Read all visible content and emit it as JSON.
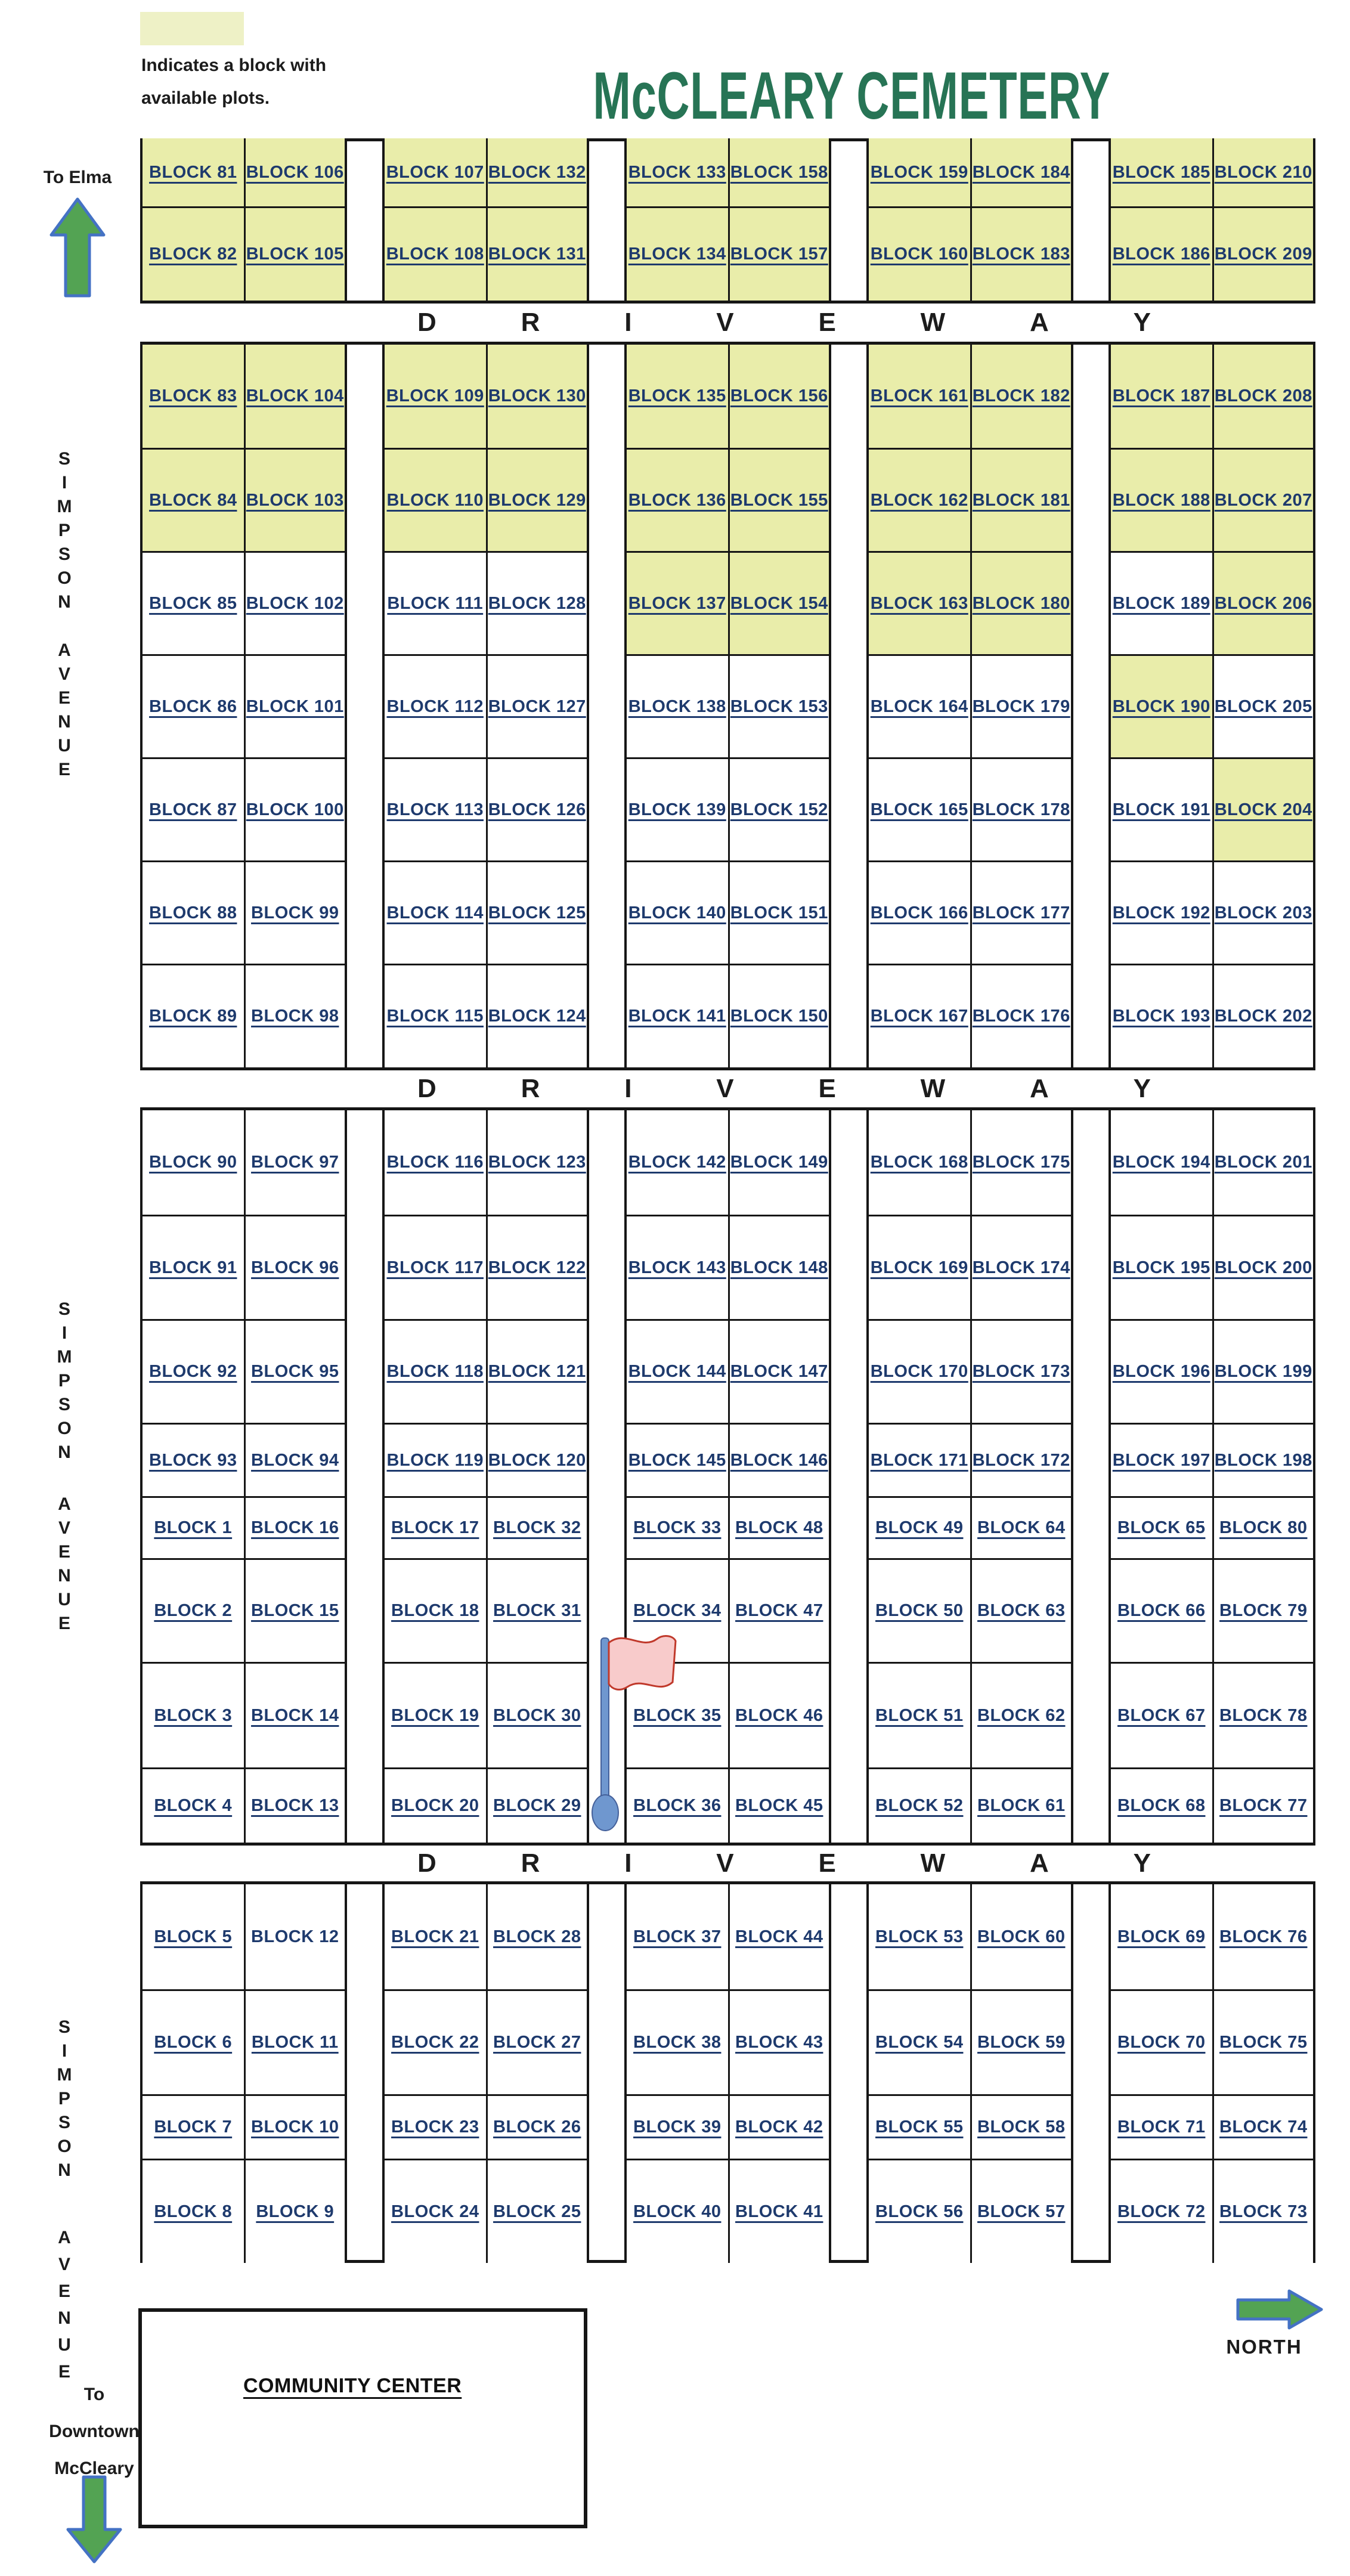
{
  "title": "McCLEARY CEMETERY",
  "legend": {
    "line1": "Indicates a block with",
    "line2": "available plots."
  },
  "driveway_letters": [
    "D",
    "R",
    "I",
    "V",
    "E",
    "W",
    "A",
    "Y"
  ],
  "streets": {
    "simpson": "SIMPSON",
    "avenue": "AVENUE"
  },
  "directions": {
    "to_elma": "To Elma",
    "to_downtown": [
      "To",
      "Downtown",
      "McCleary"
    ],
    "north": "NORTH"
  },
  "community_center": "COMMUNITY CENTER",
  "colors": {
    "available_fill": "#e9edaa",
    "legend_fill": "#eef1c6",
    "label_navy": "#1e3a6d",
    "title_green": "#277455",
    "arrow_green": "#53a353",
    "arrow_blue": "#4472c4",
    "flag_pink": "#f8cbcb",
    "flag_red": "#c0392b",
    "pole_blue": "#6f97cf"
  },
  "available_blocks": [
    81,
    82,
    105,
    106,
    107,
    108,
    131,
    132,
    133,
    134,
    157,
    158,
    159,
    160,
    183,
    184,
    185,
    186,
    209,
    210,
    83,
    84,
    103,
    104,
    109,
    110,
    129,
    130,
    135,
    136,
    155,
    156,
    161,
    162,
    181,
    182,
    187,
    188,
    207,
    208,
    137,
    154,
    163,
    180,
    206,
    190,
    204
  ],
  "not_underlined_blocks": [
    12
  ],
  "sections": [
    {
      "id": "section-north",
      "groups": [
        {
          "rows": [
            [
              "BLOCK 81",
              "BLOCK 106"
            ],
            [
              "BLOCK 82",
              "BLOCK 105"
            ]
          ]
        },
        {
          "rows": [
            [
              "BLOCK 107",
              "BLOCK 132"
            ],
            [
              "BLOCK 108",
              "BLOCK 131"
            ]
          ]
        },
        {
          "rows": [
            [
              "BLOCK 133",
              "BLOCK 158"
            ],
            [
              "BLOCK 134",
              "BLOCK 157"
            ]
          ]
        },
        {
          "rows": [
            [
              "BLOCK 159",
              "BLOCK 184"
            ],
            [
              "BLOCK 160",
              "BLOCK 183"
            ]
          ]
        },
        {
          "rows": [
            [
              "BLOCK 185",
              "BLOCK 210"
            ],
            [
              "BLOCK 186",
              "BLOCK 209"
            ]
          ]
        }
      ]
    },
    {
      "id": "section-upper-middle",
      "groups": [
        {
          "rows": [
            [
              "BLOCK 83",
              "BLOCK 104"
            ],
            [
              "BLOCK 84",
              "BLOCK 103"
            ],
            [
              "BLOCK 85",
              "BLOCK 102"
            ],
            [
              "BLOCK 86",
              "BLOCK 101"
            ],
            [
              "BLOCK 87",
              "BLOCK 100"
            ],
            [
              "BLOCK 88",
              "BLOCK 99"
            ],
            [
              "BLOCK 89",
              "BLOCK 98"
            ]
          ]
        },
        {
          "rows": [
            [
              "BLOCK 109",
              "BLOCK 130"
            ],
            [
              "BLOCK 110",
              "BLOCK 129"
            ],
            [
              "BLOCK 111",
              "BLOCK 128"
            ],
            [
              "BLOCK 112",
              "BLOCK 127"
            ],
            [
              "BLOCK 113",
              "BLOCK 126"
            ],
            [
              "BLOCK 114",
              "BLOCK 125"
            ],
            [
              "BLOCK 115",
              "BLOCK 124"
            ]
          ]
        },
        {
          "rows": [
            [
              "BLOCK 135",
              "BLOCK 156"
            ],
            [
              "BLOCK 136",
              "BLOCK 155"
            ],
            [
              "BLOCK 137",
              "BLOCK 154"
            ],
            [
              "BLOCK 138",
              "BLOCK 153"
            ],
            [
              "BLOCK 139",
              "BLOCK 152"
            ],
            [
              "BLOCK 140",
              "BLOCK 151"
            ],
            [
              "BLOCK 141",
              "BLOCK 150"
            ]
          ]
        },
        {
          "rows": [
            [
              "BLOCK 161",
              "BLOCK 182"
            ],
            [
              "BLOCK 162",
              "BLOCK 181"
            ],
            [
              "BLOCK 163",
              "BLOCK 180"
            ],
            [
              "BLOCK 164",
              "BLOCK 179"
            ],
            [
              "BLOCK 165",
              "BLOCK 178"
            ],
            [
              "BLOCK 166",
              "BLOCK 177"
            ],
            [
              "BLOCK 167",
              "BLOCK 176"
            ]
          ]
        },
        {
          "rows": [
            [
              "BLOCK 187",
              "BLOCK 208"
            ],
            [
              "BLOCK 188",
              "BLOCK 207"
            ],
            [
              "BLOCK 189",
              "BLOCK 206"
            ],
            [
              "BLOCK 190",
              "BLOCK 205"
            ],
            [
              "BLOCK 191",
              "BLOCK 204"
            ],
            [
              "BLOCK 192",
              "BLOCK 203"
            ],
            [
              "BLOCK 193",
              "BLOCK 202"
            ]
          ]
        }
      ]
    },
    {
      "id": "section-lower-middle",
      "groups": [
        {
          "rows": [
            [
              "BLOCK 90",
              "BLOCK 97"
            ],
            [
              "BLOCK 91",
              "BLOCK 96"
            ],
            [
              "BLOCK 92",
              "BLOCK 95"
            ],
            [
              "BLOCK 93",
              "BLOCK 94"
            ],
            [
              "BLOCK 1",
              "BLOCK 16"
            ],
            [
              "BLOCK 2",
              "BLOCK 15"
            ],
            [
              "BLOCK 3",
              "BLOCK 14"
            ],
            [
              "BLOCK 4",
              "BLOCK 13"
            ]
          ]
        },
        {
          "rows": [
            [
              "BLOCK 116",
              "BLOCK 123"
            ],
            [
              "BLOCK 117",
              "BLOCK 122"
            ],
            [
              "BLOCK 118",
              "BLOCK 121"
            ],
            [
              "BLOCK 119",
              "BLOCK 120"
            ],
            [
              "BLOCK 17",
              "BLOCK 32"
            ],
            [
              "BLOCK 18",
              "BLOCK 31"
            ],
            [
              "BLOCK 19",
              "BLOCK 30"
            ],
            [
              "BLOCK 20",
              "BLOCK 29"
            ]
          ]
        },
        {
          "rows": [
            [
              "BLOCK 142",
              "BLOCK 149"
            ],
            [
              "BLOCK 143",
              "BLOCK 148"
            ],
            [
              "BLOCK 144",
              "BLOCK 147"
            ],
            [
              "BLOCK 145",
              "BLOCK 146"
            ],
            [
              "BLOCK 33",
              "BLOCK 48"
            ],
            [
              "BLOCK 34",
              "BLOCK 47"
            ],
            [
              "BLOCK 35",
              "BLOCK 46"
            ],
            [
              "BLOCK 36",
              "BLOCK 45"
            ]
          ]
        },
        {
          "rows": [
            [
              "BLOCK 168",
              "BLOCK 175"
            ],
            [
              "BLOCK 169",
              "BLOCK 174"
            ],
            [
              "BLOCK 170",
              "BLOCK 173"
            ],
            [
              "BLOCK 171",
              "BLOCK 172"
            ],
            [
              "BLOCK 49",
              "BLOCK 64"
            ],
            [
              "BLOCK 50",
              "BLOCK 63"
            ],
            [
              "BLOCK 51",
              "BLOCK 62"
            ],
            [
              "BLOCK 52",
              "BLOCK 61"
            ]
          ]
        },
        {
          "rows": [
            [
              "BLOCK 194",
              "BLOCK 201"
            ],
            [
              "BLOCK 195",
              "BLOCK 200"
            ],
            [
              "BLOCK 196",
              "BLOCK 199"
            ],
            [
              "BLOCK 197",
              "BLOCK 198"
            ],
            [
              "BLOCK 65",
              "BLOCK 80"
            ],
            [
              "BLOCK 66",
              "BLOCK 79"
            ],
            [
              "BLOCK 67",
              "BLOCK 78"
            ],
            [
              "BLOCK 68",
              "BLOCK 77"
            ]
          ]
        }
      ]
    },
    {
      "id": "section-south",
      "groups": [
        {
          "rows": [
            [
              "BLOCK 5",
              "BLOCK 12"
            ],
            [
              "BLOCK 6",
              "BLOCK 11"
            ],
            [
              "BLOCK 7",
              "BLOCK 10"
            ],
            [
              "BLOCK 8",
              "BLOCK 9"
            ]
          ]
        },
        {
          "rows": [
            [
              "BLOCK 21",
              "BLOCK 28"
            ],
            [
              "BLOCK 22",
              "BLOCK 27"
            ],
            [
              "BLOCK 23",
              "BLOCK 26"
            ],
            [
              "BLOCK 24",
              "BLOCK 25"
            ]
          ]
        },
        {
          "rows": [
            [
              "BLOCK 37",
              "BLOCK 44"
            ],
            [
              "BLOCK 38",
              "BLOCK 43"
            ],
            [
              "BLOCK 39",
              "BLOCK 42"
            ],
            [
              "BLOCK 40",
              "BLOCK 41"
            ]
          ]
        },
        {
          "rows": [
            [
              "BLOCK 53",
              "BLOCK 60"
            ],
            [
              "BLOCK 54",
              "BLOCK 59"
            ],
            [
              "BLOCK 55",
              "BLOCK 58"
            ],
            [
              "BLOCK 56",
              "BLOCK 57"
            ]
          ]
        },
        {
          "rows": [
            [
              "BLOCK 69",
              "BLOCK 76"
            ],
            [
              "BLOCK 70",
              "BLOCK 75"
            ],
            [
              "BLOCK 71",
              "BLOCK 74"
            ],
            [
              "BLOCK 72",
              "BLOCK 73"
            ]
          ]
        }
      ]
    }
  ]
}
